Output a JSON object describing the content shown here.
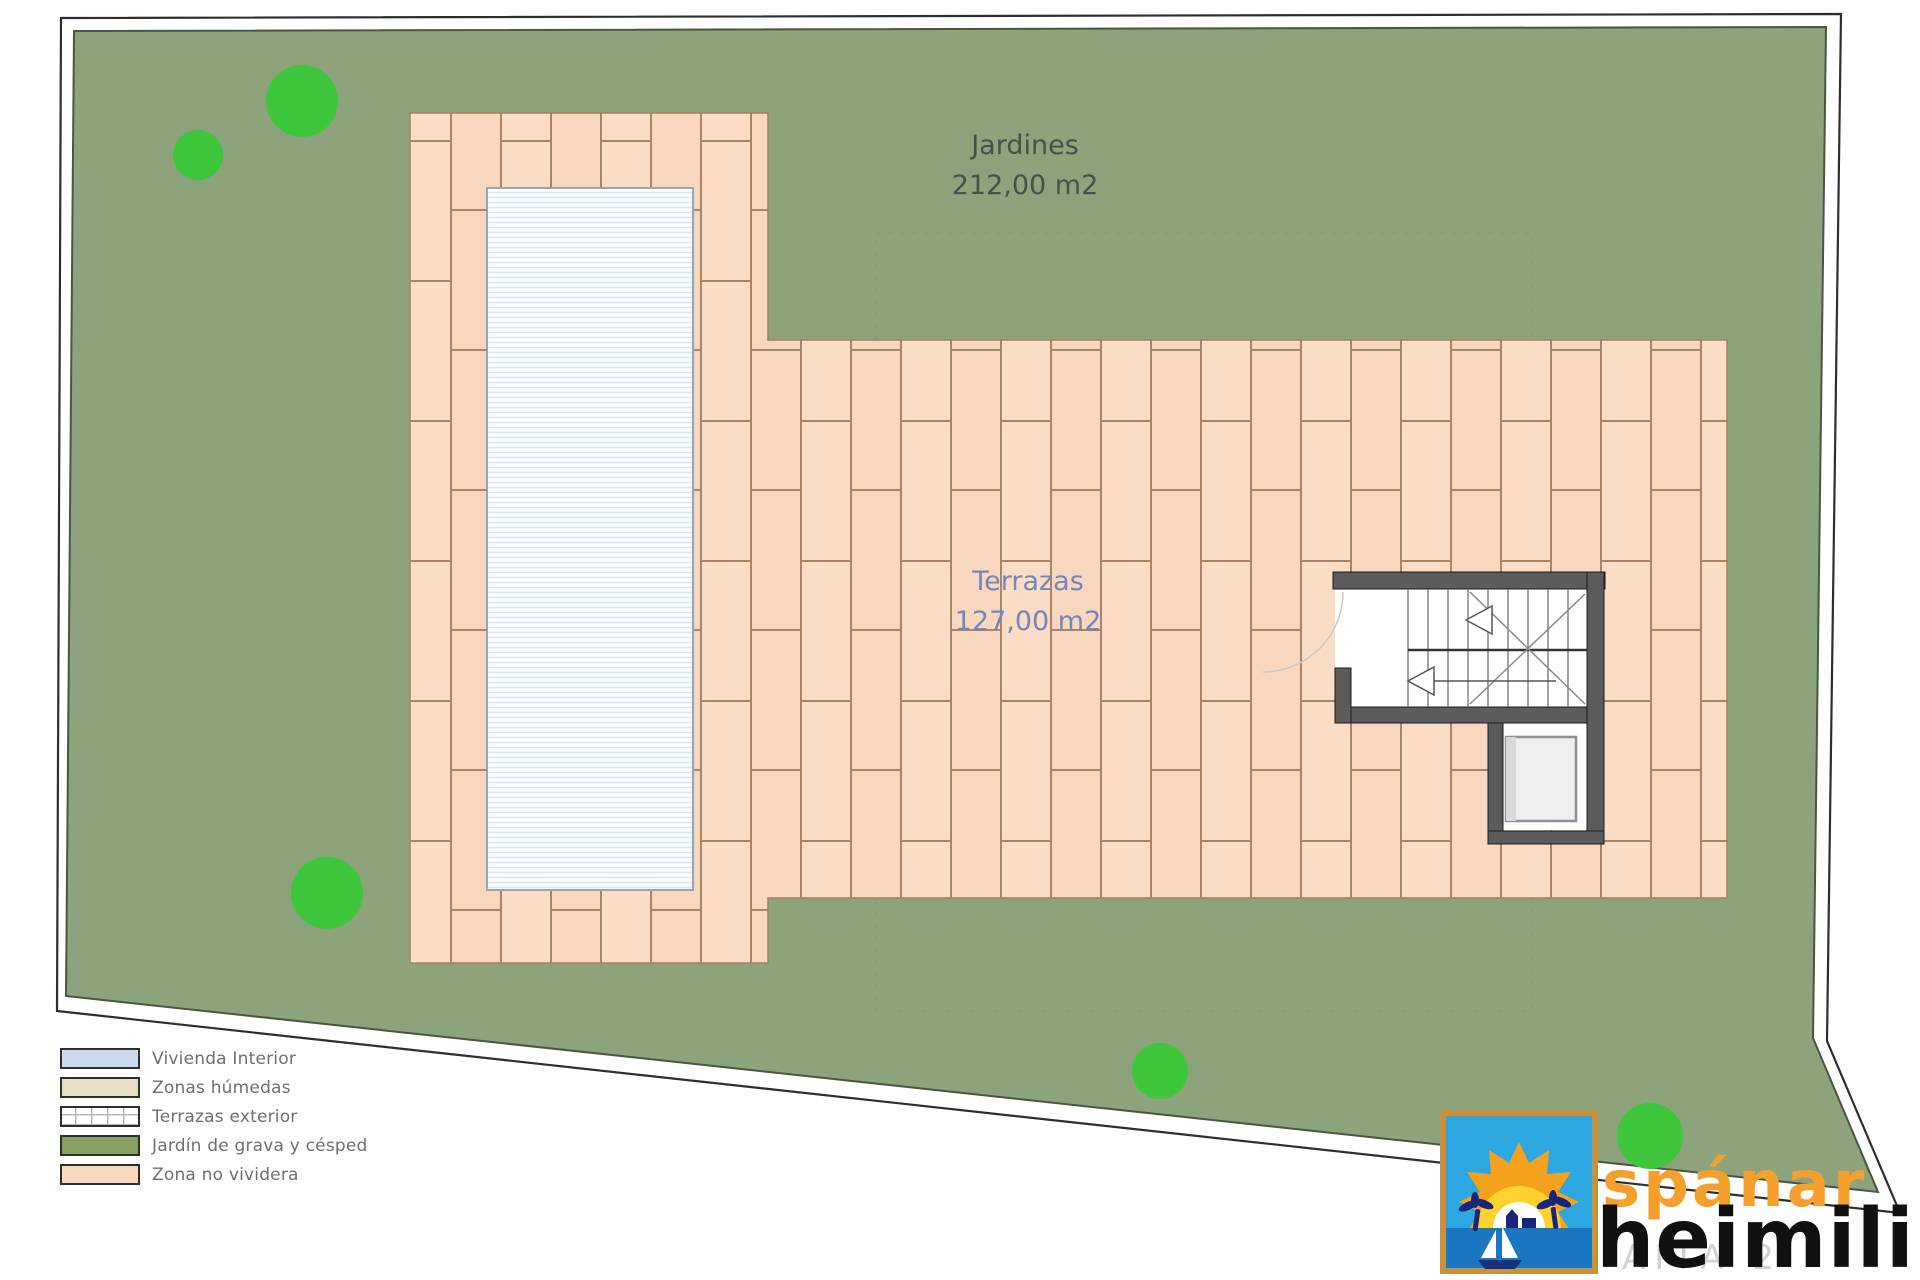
{
  "plan": {
    "garden_label": {
      "name": "Jardines",
      "area": "212,00 m2"
    },
    "terrace_label": {
      "name": "Terrazas",
      "area": "127,00 m2"
    }
  },
  "legend": {
    "items": [
      {
        "label": "Vivienda Interior"
      },
      {
        "label": "Zonas húmedas"
      },
      {
        "label": "Terrazas exterior"
      },
      {
        "label": "Jardín de grava y césped"
      },
      {
        "label": "Zona no vividera"
      }
    ]
  },
  "logo": {
    "brand_top": "spánar",
    "brand_bottom": "heimili",
    "watermark": "AITA 2"
  },
  "colors": {
    "garden": "#8CA37B",
    "garden_edge": "#55663F",
    "tree": "#3EC73C",
    "tile_face": "#FBDDC6",
    "tile_joint": "#AB8365",
    "paved_edge": "#A5815F",
    "pool_stripe": "#D7E6F4",
    "pool_edge": "#93A7B5",
    "wall": "#5B5B5B",
    "outline": "#2E2E2E",
    "label_green": "#46514B",
    "label_blue": "#7189B9",
    "legend_text": "#6F6F6F",
    "vivienda": "#CCD9EF",
    "humedas": "#E7DFC3",
    "terraza": "#FFFFFF",
    "jardin": "#85A061",
    "no_vividera": "#FBD9BE",
    "brand_orange": "#F5A02D",
    "brand_black": "#111111"
  }
}
